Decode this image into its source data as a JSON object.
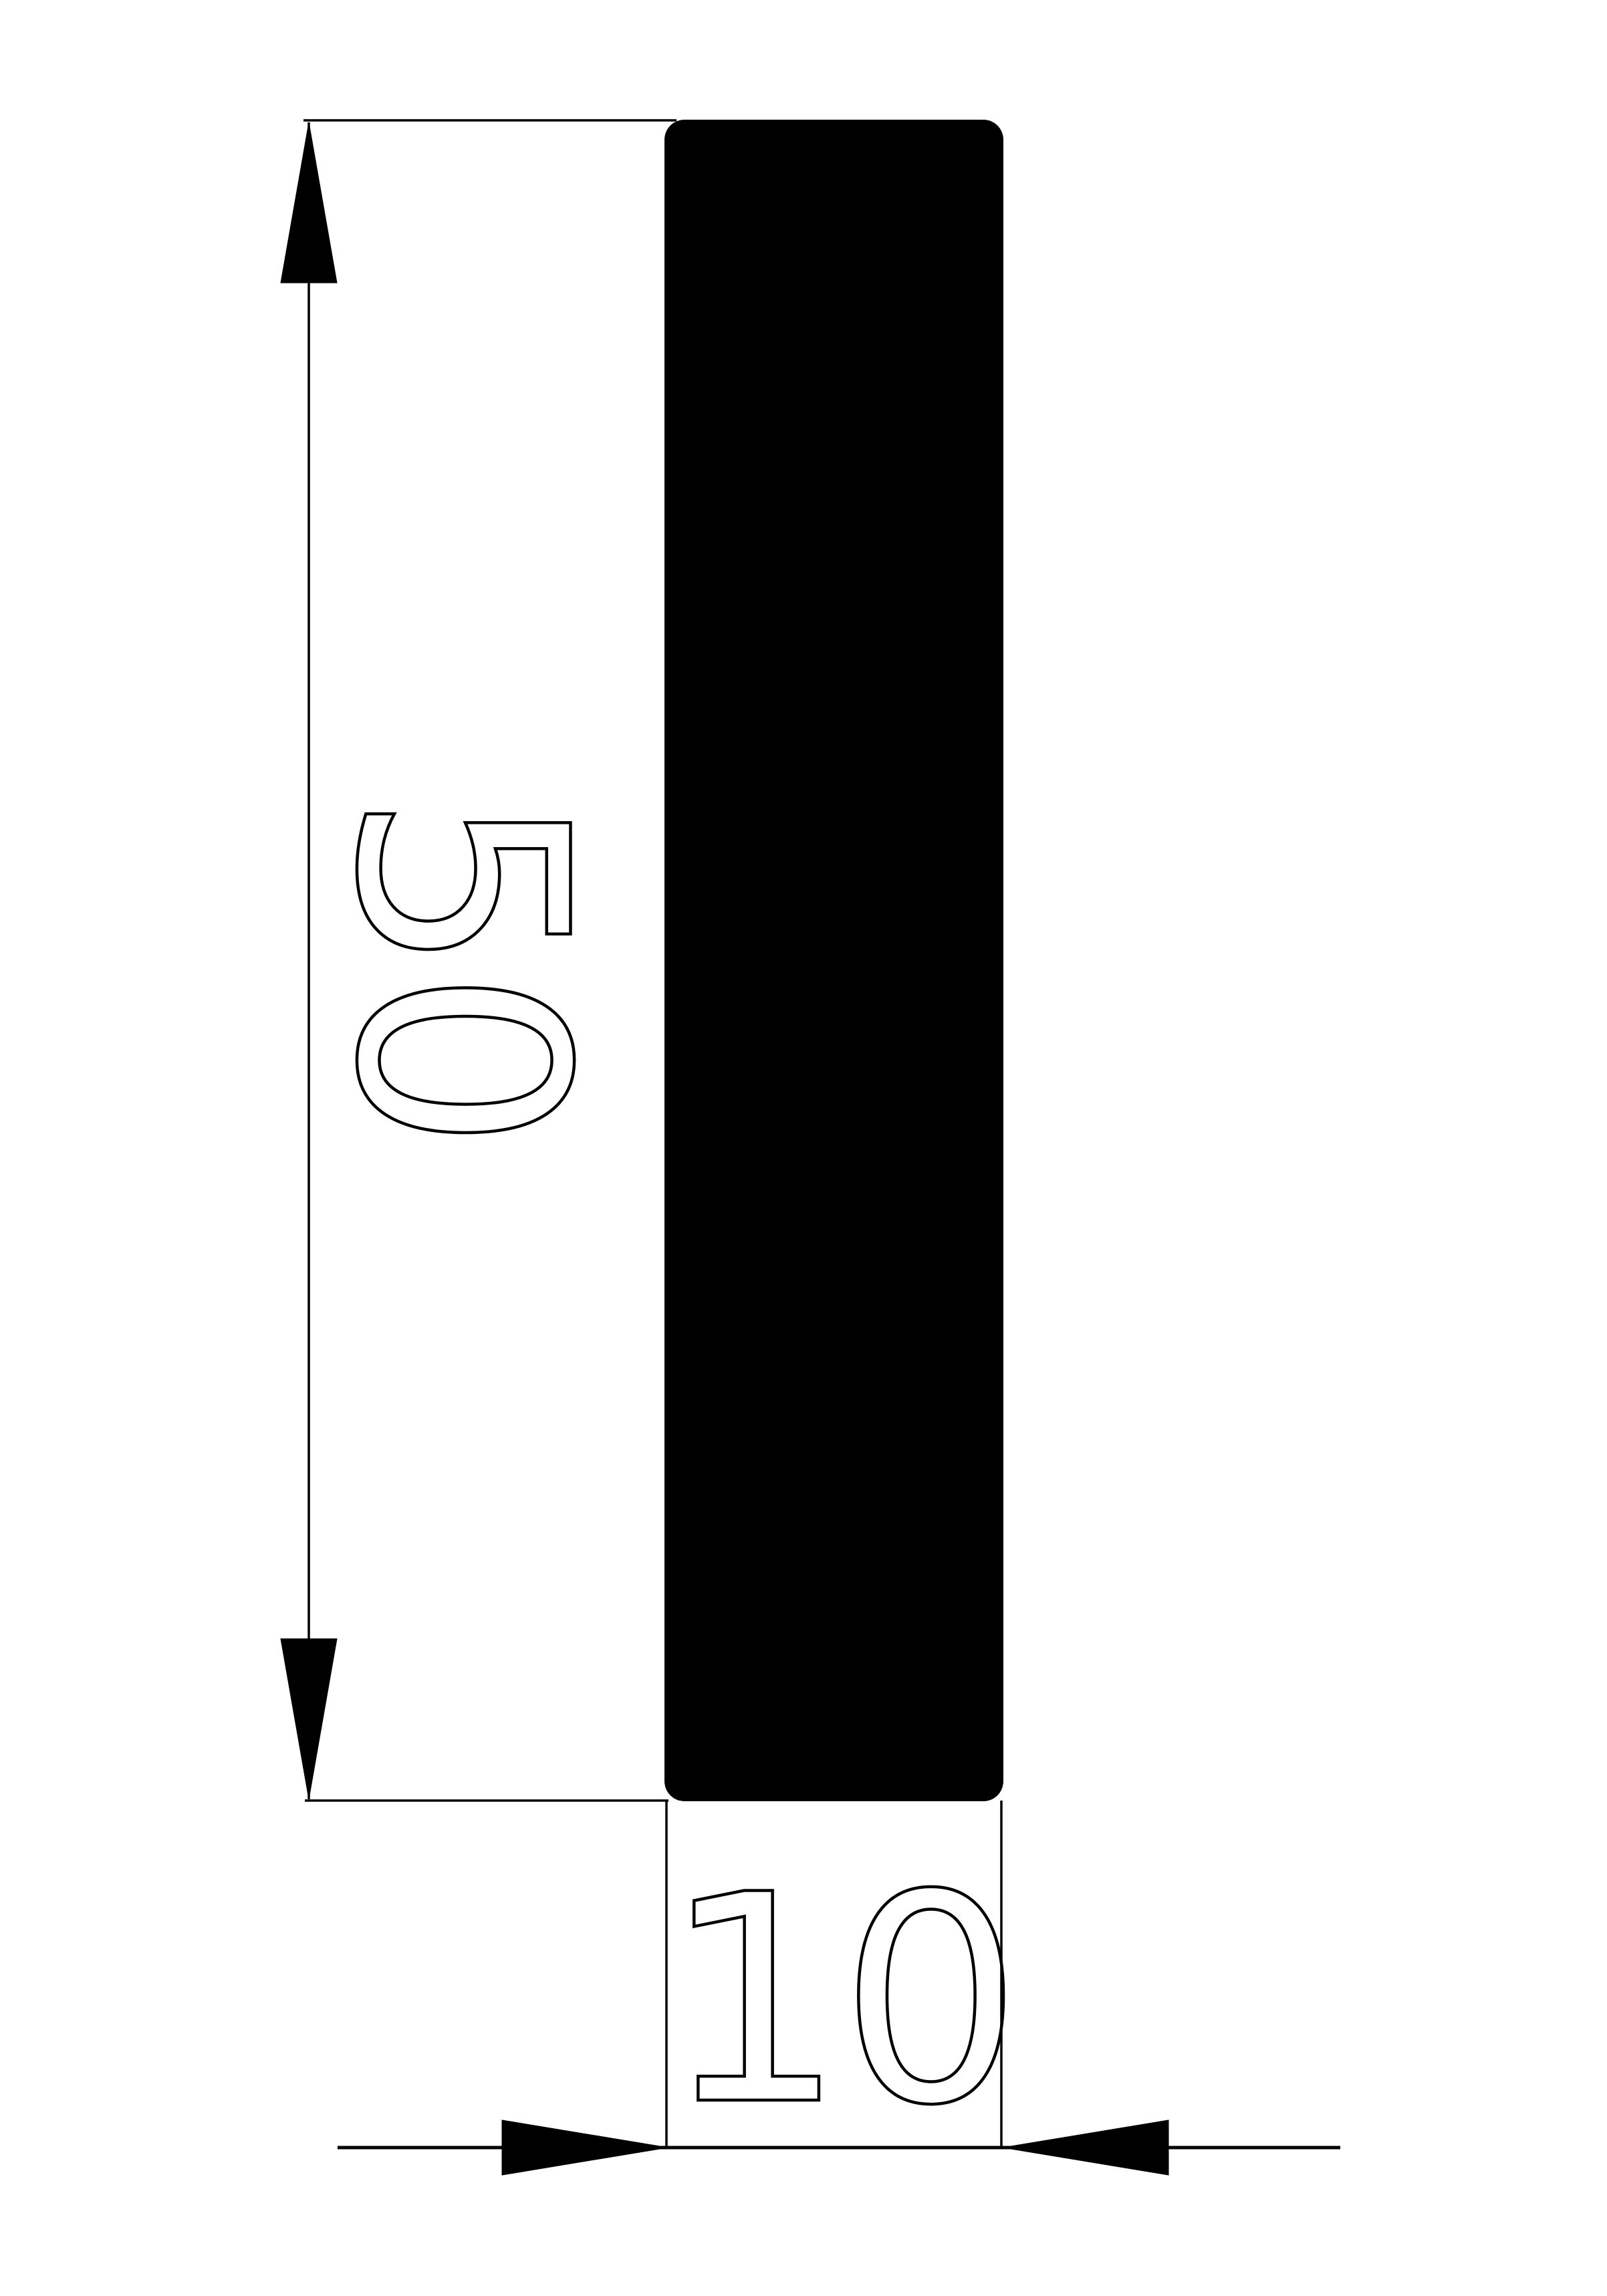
{
  "drawing": {
    "background_color": "#ffffff",
    "line_color": "#000000",
    "profile_fill": "#000000",
    "dimensions": {
      "height": {
        "value": "50"
      },
      "width": {
        "value": "10"
      }
    }
  }
}
